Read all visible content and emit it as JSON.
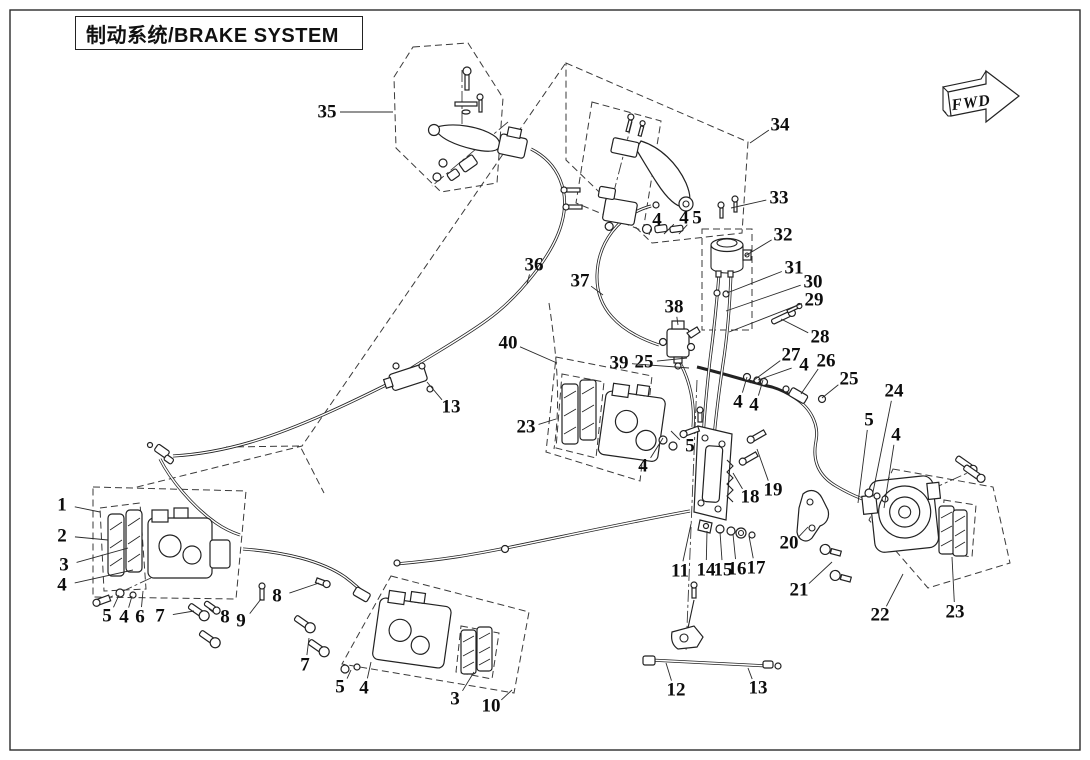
{
  "page": {
    "title": "制动系统/BRAKE SYSTEM",
    "fwd_label": "FWD"
  },
  "diagram": {
    "type": "exploded-parts-diagram",
    "subject": "brake-system",
    "callouts": [
      {
        "n": "1",
        "x": 62,
        "y": 505,
        "tx": 100,
        "ty": 512
      },
      {
        "n": "2",
        "x": 62,
        "y": 536,
        "tx": 108,
        "ty": 540
      },
      {
        "n": "3",
        "x": 64,
        "y": 565,
        "tx": 128,
        "ty": 548
      },
      {
        "n": "4",
        "x": 62,
        "y": 585,
        "tx": 133,
        "ty": 570
      },
      {
        "n": "5",
        "x": 107,
        "y": 616,
        "tx": 119,
        "ty": 595
      },
      {
        "n": "4",
        "x": 124,
        "y": 617,
        "tx": 132,
        "ty": 596
      },
      {
        "n": "6",
        "x": 140,
        "y": 617,
        "tx": 143,
        "ty": 591
      },
      {
        "n": "7",
        "x": 160,
        "y": 616,
        "tx": 194,
        "ty": 611
      },
      {
        "n": "8",
        "x": 225,
        "y": 617,
        "tx": 209,
        "ty": 609
      },
      {
        "n": "9",
        "x": 241,
        "y": 621,
        "tx": 261,
        "ty": 599
      },
      {
        "n": "8",
        "x": 277,
        "y": 596,
        "tx": 319,
        "ty": 583
      },
      {
        "n": "7",
        "x": 305,
        "y": 665,
        "tx": 309,
        "ty": 638
      },
      {
        "n": "5",
        "x": 340,
        "y": 687,
        "tx": 351,
        "ty": 670
      },
      {
        "n": "4",
        "x": 364,
        "y": 688,
        "tx": 371,
        "ty": 662
      },
      {
        "n": "3",
        "x": 455,
        "y": 699,
        "tx": 474,
        "ty": 672
      },
      {
        "n": "10",
        "x": 491,
        "y": 706,
        "tx": 512,
        "ty": 690
      },
      {
        "n": "11",
        "x": 680,
        "y": 571,
        "tx": 691,
        "ty": 524
      },
      {
        "n": "14",
        "x": 706,
        "y": 570,
        "tx": 707,
        "ty": 531
      },
      {
        "n": "15",
        "x": 723,
        "y": 570,
        "tx": 720,
        "ty": 532
      },
      {
        "n": "16",
        "x": 737,
        "y": 569,
        "tx": 733,
        "ty": 534
      },
      {
        "n": "17",
        "x": 756,
        "y": 568,
        "tx": 749,
        "ty": 536
      },
      {
        "n": "12",
        "x": 676,
        "y": 690,
        "tx": 666,
        "ty": 663
      },
      {
        "n": "13",
        "x": 758,
        "y": 688,
        "tx": 748,
        "ty": 668
      },
      {
        "n": "18",
        "x": 750,
        "y": 497,
        "tx": 733,
        "ty": 473
      },
      {
        "n": "19",
        "x": 773,
        "y": 490,
        "tx": 757,
        "ty": 449
      },
      {
        "n": "20",
        "x": 789,
        "y": 543,
        "tx": 808,
        "ty": 527
      },
      {
        "n": "21",
        "x": 799,
        "y": 590,
        "tx": 832,
        "ty": 562
      },
      {
        "n": "22",
        "x": 880,
        "y": 615,
        "tx": 903,
        "ty": 574
      },
      {
        "n": "23",
        "x": 955,
        "y": 612,
        "tx": 952,
        "ty": 557
      },
      {
        "n": "24",
        "x": 894,
        "y": 391,
        "tx": 872,
        "ty": 497
      },
      {
        "n": "5",
        "x": 869,
        "y": 420,
        "tx": 858,
        "ty": 503
      },
      {
        "n": "4",
        "x": 896,
        "y": 435,
        "tx": 884,
        "ty": 508
      },
      {
        "n": "25",
        "x": 849,
        "y": 379,
        "tx": 822,
        "ty": 398
      },
      {
        "n": "26",
        "x": 826,
        "y": 361,
        "tx": 801,
        "ty": 394
      },
      {
        "n": "27",
        "x": 791,
        "y": 355,
        "tx": 750,
        "ty": 383
      },
      {
        "n": "4",
        "x": 804,
        "y": 365,
        "tx": 758,
        "ty": 380
      },
      {
        "n": "28",
        "x": 820,
        "y": 337,
        "tx": 781,
        "ty": 319
      },
      {
        "n": "29",
        "x": 814,
        "y": 300,
        "tx": 729,
        "ty": 332
      },
      {
        "n": "30",
        "x": 813,
        "y": 282,
        "tx": 726,
        "ty": 311
      },
      {
        "n": "31",
        "x": 794,
        "y": 268,
        "tx": 727,
        "ty": 293
      },
      {
        "n": "32",
        "x": 783,
        "y": 235,
        "tx": 745,
        "ty": 256
      },
      {
        "n": "33",
        "x": 779,
        "y": 198,
        "tx": 731,
        "ty": 208
      },
      {
        "n": "34",
        "x": 780,
        "y": 125,
        "tx": 750,
        "ty": 143
      },
      {
        "n": "35",
        "x": 327,
        "y": 112,
        "tx": 393,
        "ty": 112
      },
      {
        "n": "36",
        "x": 534,
        "y": 265,
        "tx": 527,
        "ty": 284
      },
      {
        "n": "37",
        "x": 580,
        "y": 281,
        "tx": 603,
        "ty": 295
      },
      {
        "n": "38",
        "x": 674,
        "y": 307,
        "tx": 678,
        "ty": 325
      },
      {
        "n": "39",
        "x": 619,
        "y": 363,
        "tx": 689,
        "ty": 368
      },
      {
        "n": "25",
        "x": 644,
        "y": 362,
        "tx": 687,
        "ty": 358
      },
      {
        "n": "40",
        "x": 508,
        "y": 343,
        "tx": 557,
        "ty": 363
      },
      {
        "n": "23",
        "x": 526,
        "y": 427,
        "tx": 556,
        "ty": 419
      },
      {
        "n": "13",
        "x": 451,
        "y": 407,
        "tx": 427,
        "ty": 382
      },
      {
        "n": "4",
        "x": 738,
        "y": 402,
        "tx": 747,
        "ty": 377
      },
      {
        "n": "4",
        "x": 754,
        "y": 405,
        "tx": 763,
        "ty": 380
      },
      {
        "n": "4",
        "x": 657,
        "y": 220,
        "tx": 649,
        "ty": 235
      },
      {
        "n": "4",
        "x": 684,
        "y": 218,
        "tx": 664,
        "ty": 234
      },
      {
        "n": "5",
        "x": 697,
        "y": 218,
        "tx": 679,
        "ty": 234
      },
      {
        "n": "4",
        "x": 643,
        "y": 466,
        "tx": 663,
        "ty": 438
      },
      {
        "n": "5",
        "x": 690,
        "y": 446,
        "tx": 671,
        "ty": 431
      }
    ]
  }
}
